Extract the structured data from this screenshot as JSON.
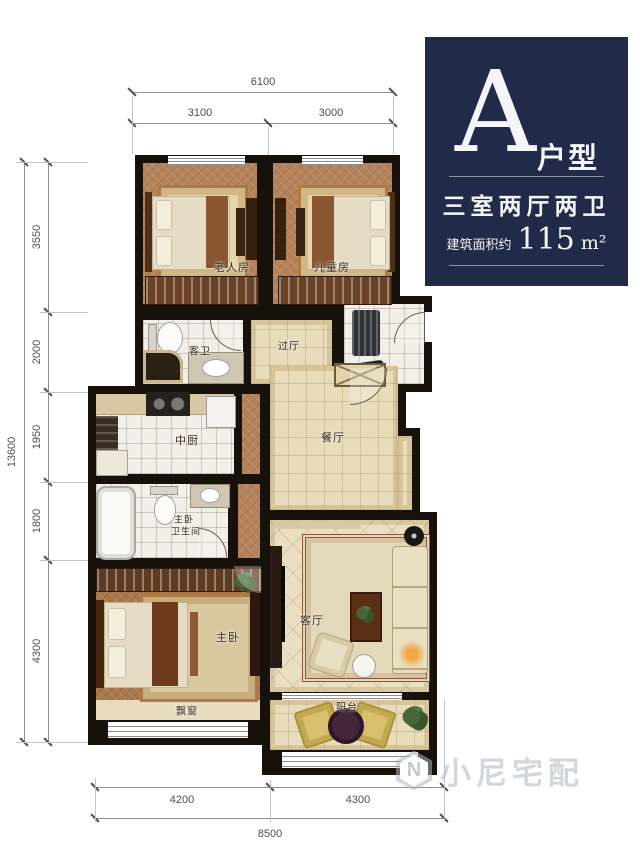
{
  "info_panel": {
    "type_letter": "A",
    "type_label": "户型",
    "rooms_summary": "三室两厅两卫",
    "area_prefix": "建筑面积约",
    "area_value": "115",
    "area_unit": "m²",
    "bg_color": "#212b49"
  },
  "room_labels": {
    "elder_room": "老人房",
    "child_room": "儿童房",
    "guest_bath": "客卫",
    "vestibule": "过厅",
    "kitchen": "中厨",
    "dining": "餐厅",
    "master_bath_line1": "主卧",
    "master_bath_line2": "卫生间",
    "master_bedroom": "主卧",
    "living_room": "客厅",
    "bay_window": "飘窗",
    "balcony": "阳台"
  },
  "dimensions": {
    "top_total": "6100",
    "top_left": "3100",
    "top_right": "3000",
    "left_total": "13600",
    "left_segments": [
      "3550",
      "2000",
      "1950",
      "1800",
      "4300"
    ],
    "bottom_left": "4200",
    "bottom_right": "4300",
    "bottom_total": "8500"
  },
  "watermark": {
    "text": "小尼宅配"
  },
  "colors": {
    "panel_bg": "#212b49",
    "wall": "#17110c",
    "wood_floor": "#b5835b",
    "tile_beige": "#e9dcba",
    "tile_white": "#f2efe8"
  }
}
